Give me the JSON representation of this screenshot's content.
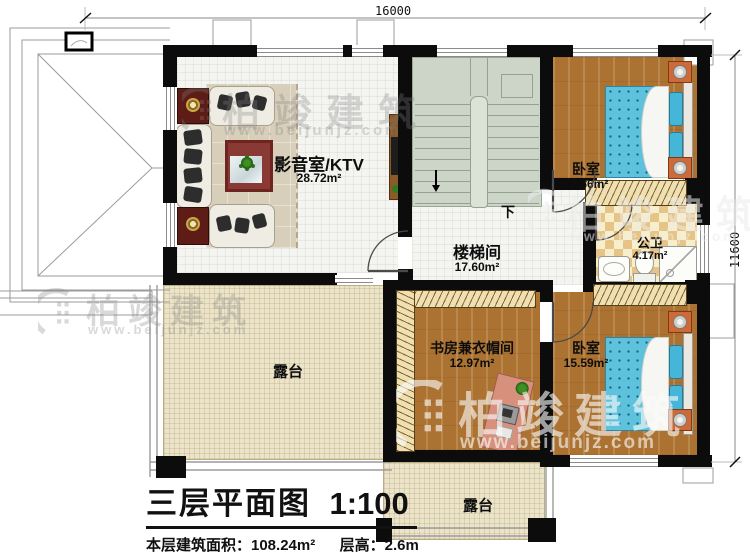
{
  "dimensions": {
    "top": "16000",
    "right": "11600"
  },
  "rooms": {
    "media_room": {
      "name": "影音室/KTV",
      "area": "28.72m²"
    },
    "stairwell": {
      "name": "楼梯间",
      "area": "17.60m²",
      "down_label": "下"
    },
    "bedroom_top": {
      "name": "卧室",
      "area": "12.66m²"
    },
    "bathroom": {
      "name": "公卫",
      "area": "4.17m²"
    },
    "study": {
      "name": "书房兼衣帽间",
      "area": "12.97m²"
    },
    "bedroom_bottom": {
      "name": "卧室",
      "area": "15.59m²"
    },
    "terrace_left": {
      "name": "露台"
    },
    "terrace_bottom": {
      "name": "露台"
    }
  },
  "title": {
    "plan_name": "三层平面图",
    "scale": "1:100",
    "floor_area": "本层建筑面积：108.24m²",
    "floor_height": "层高：2.6m"
  },
  "watermark": {
    "brand": "柏竣建筑",
    "url": "www.beijunjz.com"
  },
  "icons": {
    "watermark_logo": "building-crescent",
    "stair_direction": "down-arrow"
  },
  "colors": {
    "wall": "#0c0c0c",
    "wood_floor": "#ab7231",
    "bed": "#5fc2dd",
    "stairs": "#ccd5c8",
    "terrace": "#ece4ca",
    "bath_checker": "#e6c386",
    "nightstand": "#cf6a38",
    "speaker": "#5e1c16"
  }
}
